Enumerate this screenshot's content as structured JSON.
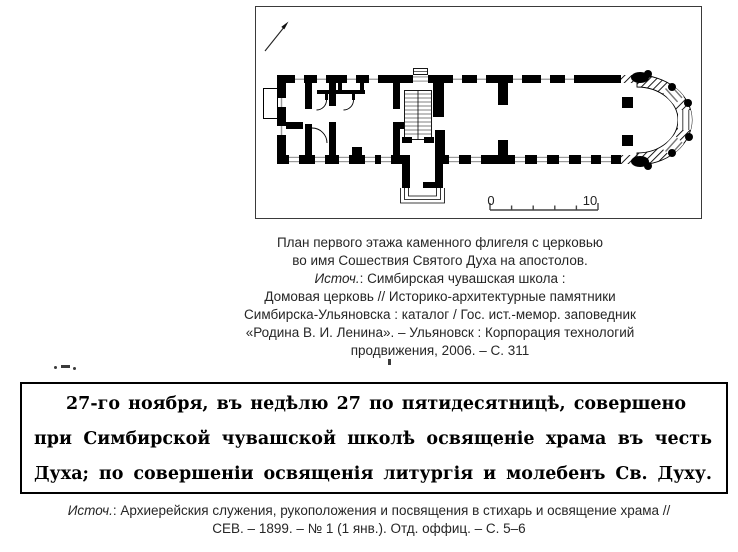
{
  "page": {
    "background": "#ffffff",
    "ink": "#000000"
  },
  "plan_figure": {
    "frame_color": "#3a3a3a",
    "north_arrow_icon": "north-arrow",
    "scale_bar": {
      "zero_label": "0",
      "ten_label": "10"
    }
  },
  "caption": {
    "line1": "План первого этажа каменного флигеля с церковью",
    "line2": "во имя Сошествия Святого Духа на апостолов.",
    "source_label": "Источ.",
    "source_rest": ": Симбирская чувашская школа :",
    "line4": "Домовая церковь // Историко-архитектурные памятники",
    "line5": "Симбирска-Ульяновска : каталог / Гос. ист.-мемор. заповедник",
    "line6": "«Родина В. И. Ленина». – Ульяновск : Корпорация технологий",
    "line7": "продвижения, 2006. – С. 311"
  },
  "excerpt": {
    "line1": "27-го ноября, въ недѣлю 27 по пятидесятницѣ, совершено",
    "line2": "при Симбирской чувашской школѣ освященіе храма въ честь Св.",
    "line3": "Духа; по совершеніи освященія литургія и молебенъ Св. Духу."
  },
  "source_citation": {
    "source_label": "Источ.",
    "line1_rest": ": Архиерейския служения, рукоположения и посвящения в стихарь и освящение храма //",
    "line2": "СЕВ. – 1899. – № 1 (1 янв.). Отд. оффиц. – С. 5–6"
  }
}
